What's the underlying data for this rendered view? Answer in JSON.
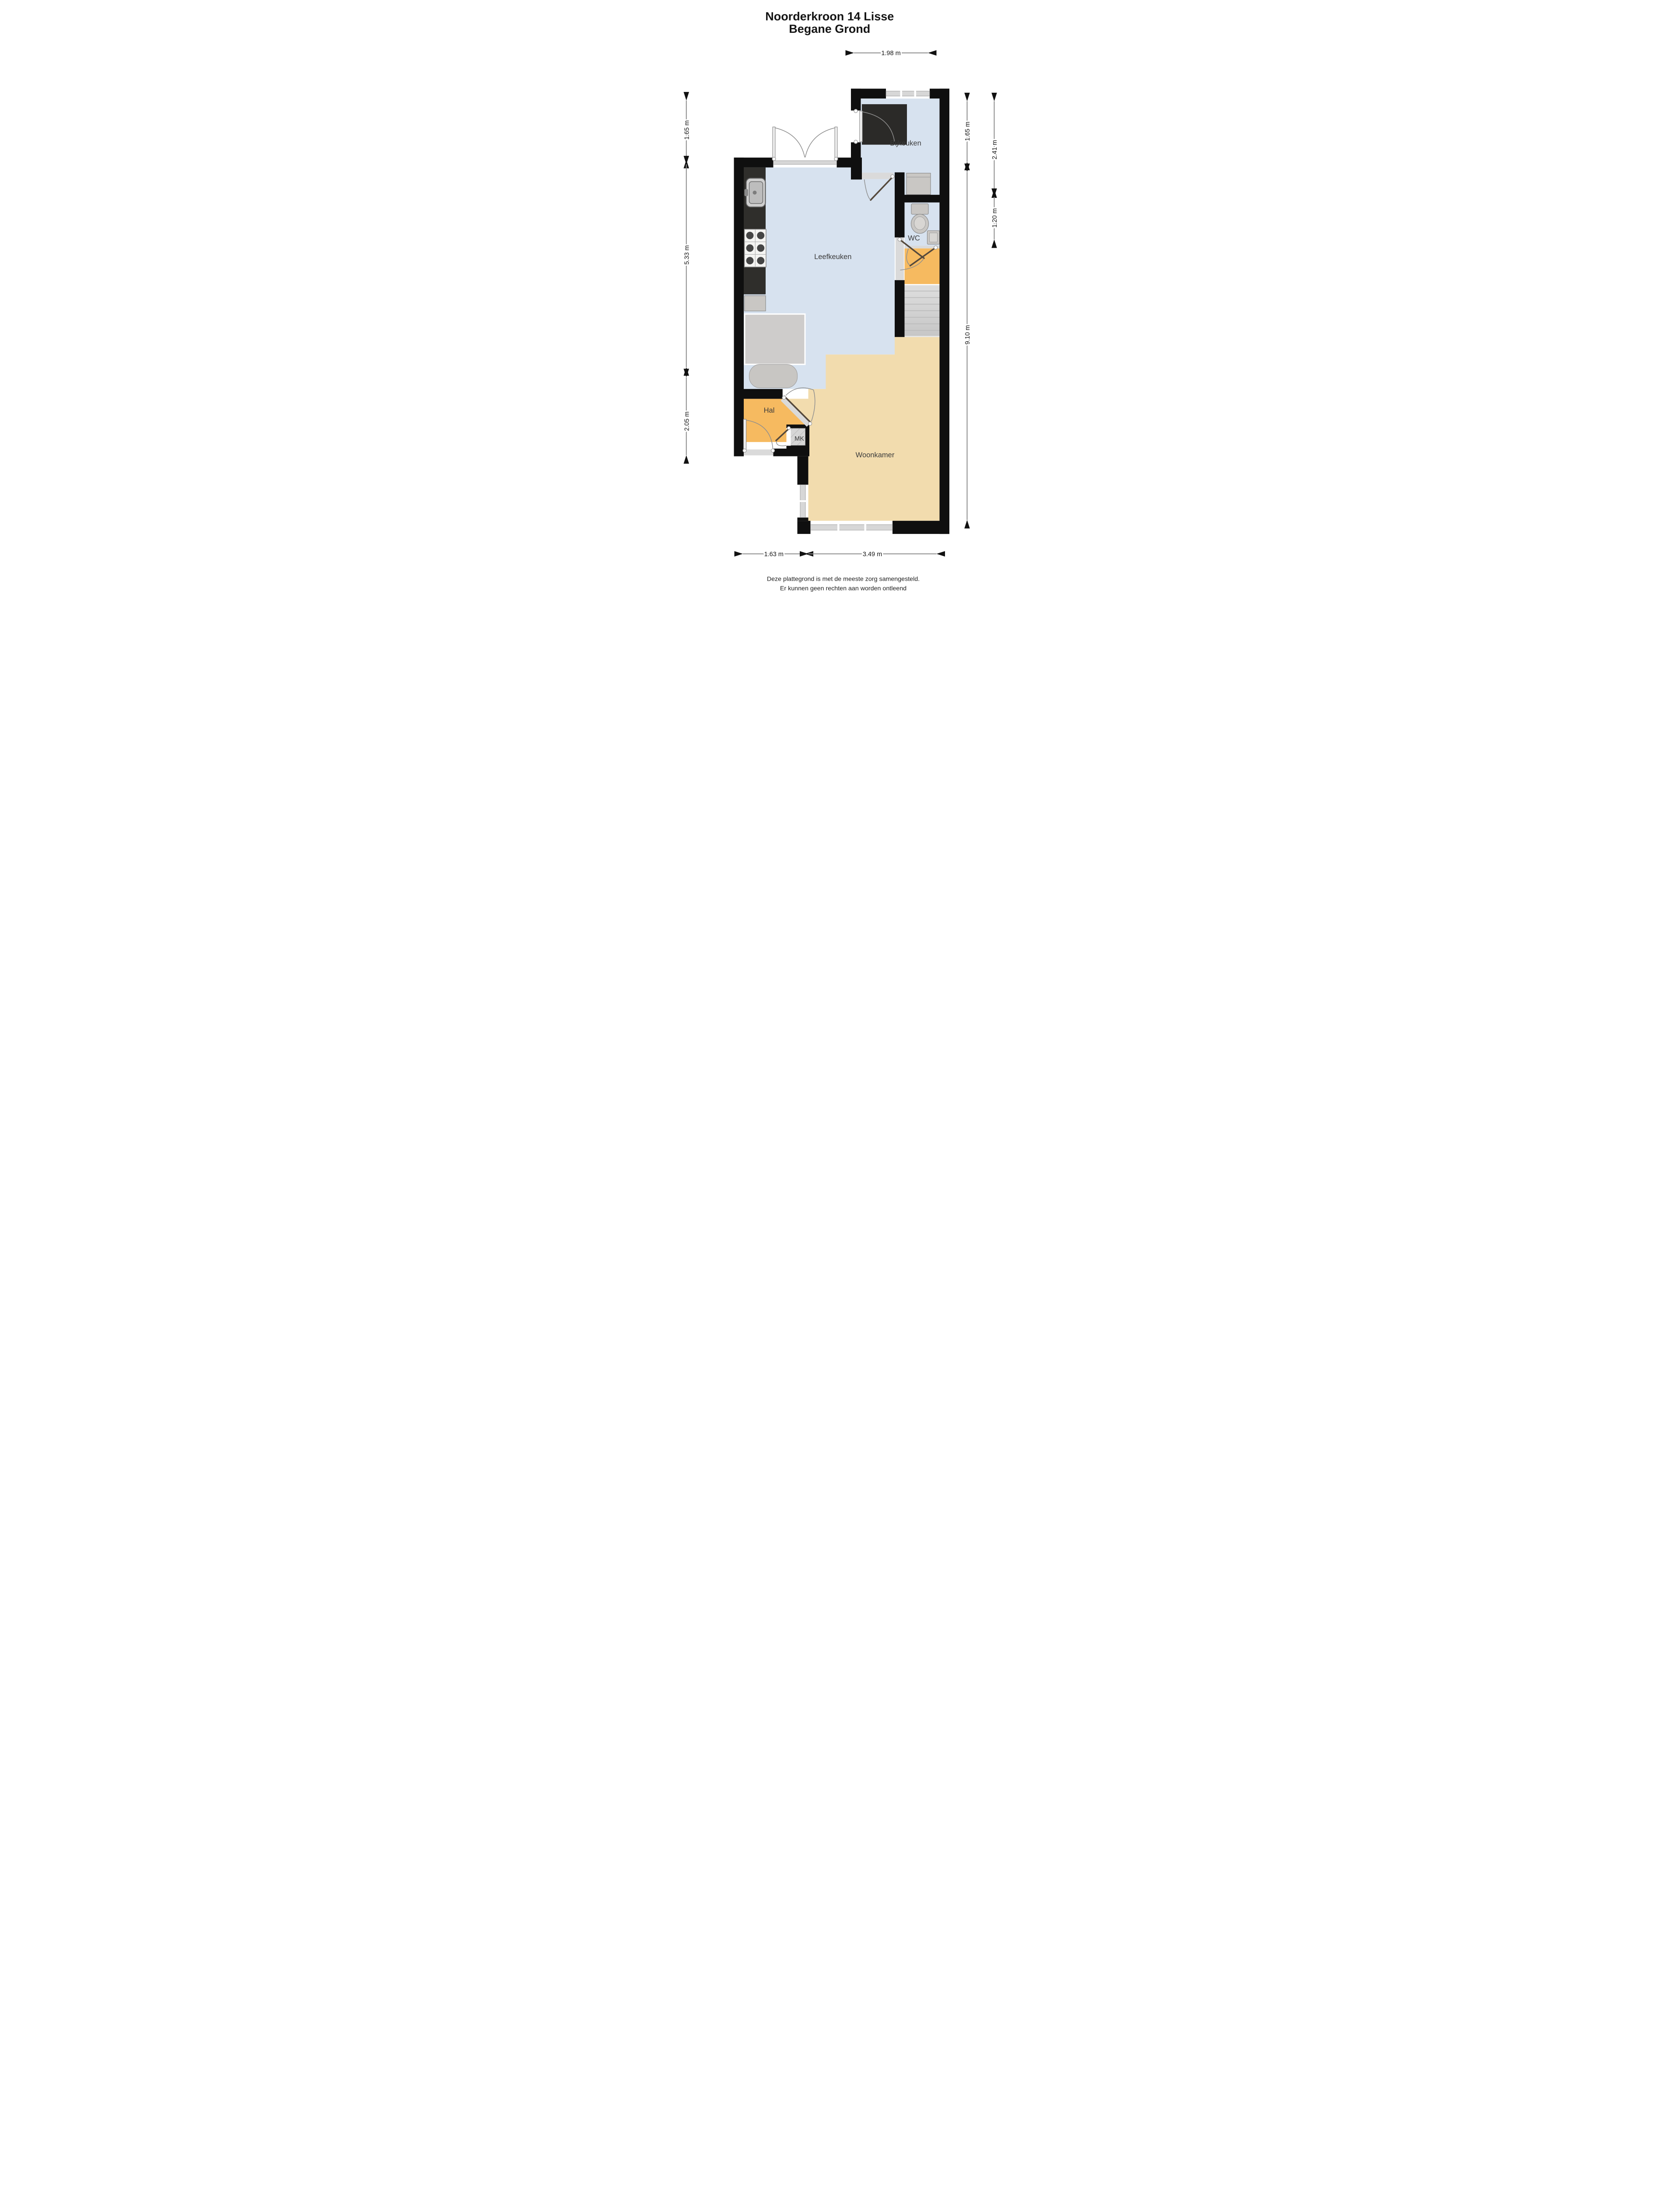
{
  "title": {
    "line1": "Noorderkroon 14 Lisse",
    "line2": "Begane Grond"
  },
  "rooms": {
    "bijkeuken": "Bijkeuken",
    "wc": "WC",
    "leefkeuken": "Leefkeuken",
    "hal": "Hal",
    "mk": "MK",
    "woonkamer": "Woonkamer"
  },
  "dimensions": {
    "top": "1.98 m",
    "left_top": "1.65 m",
    "left_middle": "5.33 m",
    "left_bottom": "2.05 m",
    "right_inner_top": "1.65 m",
    "right_inner_main": "9.10 m",
    "right_outer_top": "2.41 m",
    "right_outer_bottom": "1.20 m",
    "bottom_left": "1.63 m",
    "bottom_right": "3.49 m"
  },
  "footer": {
    "line1": "Deze plattegrond is met de meeste zorg samengesteld.",
    "line2": "Er kunnen geen rechten aan worden ontleend"
  },
  "fixtures": [
    "kitchen-sink",
    "stove",
    "kitchen-counter",
    "washing-machine",
    "toilet",
    "wc-sink",
    "stairs",
    "cupboard",
    "table"
  ],
  "colors": {
    "wall": "#0f0f0f",
    "room_blue": "#d7e2ef",
    "room_orange": "#f6ba60",
    "room_tan": "#f2dcae",
    "stairs_gray": "#d2d2d2",
    "counter_dark": "#2f2e2b",
    "appliance_gray": "#c9c7c4",
    "dimension_line": "#8c8c8c",
    "text": "#141414"
  }
}
